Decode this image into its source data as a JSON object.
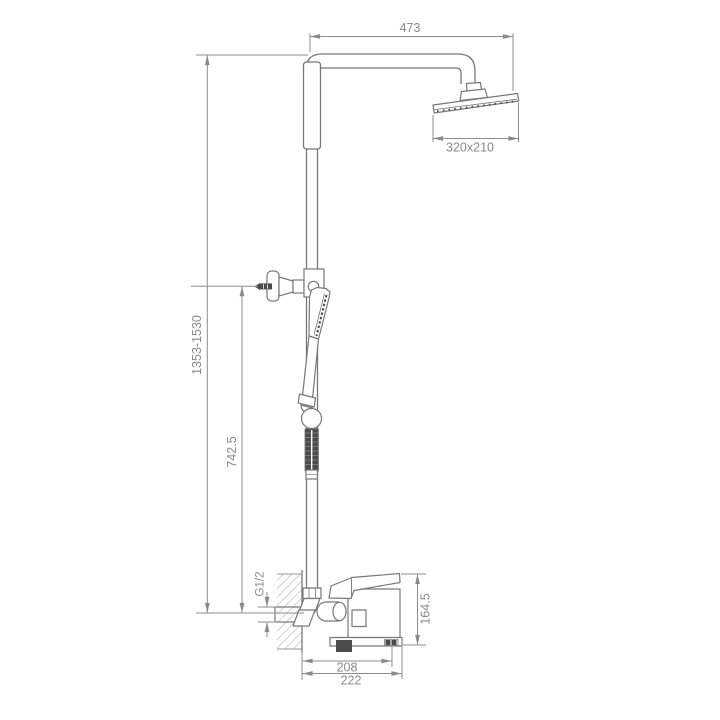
{
  "drawing": {
    "title": "shower-column-technical-drawing",
    "labels": {
      "arm_width": "473",
      "head_size": "320x210",
      "column_height": "1353-1530",
      "bracket_height": "742.5",
      "inlet_thread": "G1/2",
      "mixer_height": "164.5",
      "spout_reach": "208",
      "overall_reach": "222"
    },
    "colors": {
      "line": "#787878",
      "dimension": "#8e8e8e",
      "dark_fill": "#4b4b4b",
      "text": "#8a8a8a"
    }
  }
}
